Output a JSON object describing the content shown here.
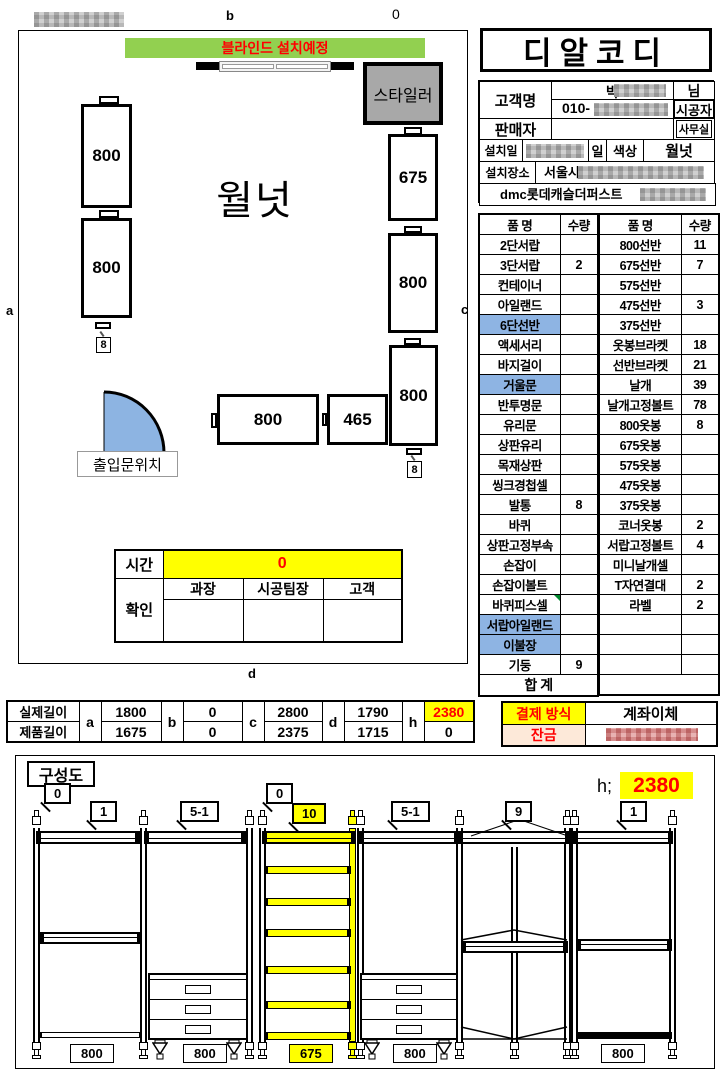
{
  "colors": {
    "banner_green": "#92D050",
    "highlight_blue": "#8EB4E3",
    "accent_yellow": "#FFFF00",
    "accent_red": "#FF0000",
    "styler_gray": "#A8A8A8",
    "door_blue": "#8DB4E2",
    "balance_bg": "#FDE9D9"
  },
  "plan": {
    "edge_labels": {
      "top": "b",
      "top_value": "0",
      "left": "a",
      "right": "c",
      "bottom": "d"
    },
    "banner": "블라인드 설치예정",
    "styler": "스타일러",
    "finish": "월넛",
    "door_label": "출입문위치",
    "units": {
      "left_1": "800",
      "left_2": "800",
      "mid_1": "800",
      "mid_2": "465",
      "right_1": "675",
      "right_2": "800",
      "right_3": "800"
    },
    "pole_markers": {
      "left": "8",
      "right": "8"
    },
    "time": {
      "label": "시간",
      "value": "0",
      "confirm_label": "확인",
      "signers": [
        "과장",
        "시공팀장",
        "고객"
      ]
    }
  },
  "header": {
    "company": "디알코디",
    "customer_label": "고객명",
    "customer_name": "박",
    "customer_suffix": "님",
    "phone_prefix": "010-",
    "installer": "시공자",
    "seller_label": "판매자",
    "office": "사무실",
    "date_label": "설치일",
    "date_suffix": "일",
    "color_label": "색상",
    "color_value": "월넛",
    "site_label": "설치장소",
    "site_city": "서울시",
    "site_detail": "dmc롯데캐슬더퍼스트"
  },
  "parts": {
    "headers": [
      "품 명",
      "수량"
    ],
    "left_rows": [
      {
        "name": "2단서랍",
        "qty": ""
      },
      {
        "name": "3단서랍",
        "qty": "2"
      },
      {
        "name": "컨테이너",
        "qty": ""
      },
      {
        "name": "아일랜드",
        "qty": ""
      },
      {
        "name": "6단선반",
        "qty": "",
        "hl": true
      },
      {
        "name": "액세서리",
        "qty": ""
      },
      {
        "name": "바지걸이",
        "qty": ""
      },
      {
        "name": "거울문",
        "qty": "",
        "hl": true
      },
      {
        "name": "반투명문",
        "qty": ""
      },
      {
        "name": "유리문",
        "qty": ""
      },
      {
        "name": "상판유리",
        "qty": ""
      },
      {
        "name": "목재상판",
        "qty": ""
      },
      {
        "name": "씽크경첩셀",
        "qty": ""
      },
      {
        "name": "발통",
        "qty": "8"
      },
      {
        "name": "바퀴",
        "qty": ""
      },
      {
        "name": "상판고정부속",
        "qty": ""
      },
      {
        "name": "손잡이",
        "qty": ""
      },
      {
        "name": "손잡이볼트",
        "qty": ""
      },
      {
        "name": "바퀴피스셀",
        "qty": "",
        "marker": true
      },
      {
        "name": "서랍아일랜드",
        "qty": "",
        "hl": true
      },
      {
        "name": "이불장",
        "qty": "",
        "hl": true
      },
      {
        "name": "기둥",
        "qty": "9"
      }
    ],
    "left_total": "합 계",
    "right_rows": [
      {
        "name": "800선반",
        "qty": "11"
      },
      {
        "name": "675선반",
        "qty": "7"
      },
      {
        "name": "575선반",
        "qty": ""
      },
      {
        "name": "475선반",
        "qty": "3"
      },
      {
        "name": "375선반",
        "qty": ""
      },
      {
        "name": "옷봉브라켓",
        "qty": "18"
      },
      {
        "name": "선반브라켓",
        "qty": "21"
      },
      {
        "name": "날개",
        "qty": "39"
      },
      {
        "name": "날개고정볼트",
        "qty": "78"
      },
      {
        "name": "800옷봉",
        "qty": "8"
      },
      {
        "name": "675옷봉",
        "qty": ""
      },
      {
        "name": "575옷봉",
        "qty": ""
      },
      {
        "name": "475옷봉",
        "qty": ""
      },
      {
        "name": "375옷봉",
        "qty": ""
      },
      {
        "name": "코너옷봉",
        "qty": "2"
      },
      {
        "name": "서랍고정볼트",
        "qty": "4"
      },
      {
        "name": "미니날개셀",
        "qty": ""
      },
      {
        "name": "T자연결대",
        "qty": "2"
      },
      {
        "name": "라벨",
        "qty": "2"
      },
      {
        "name": "",
        "qty": ""
      },
      {
        "name": "",
        "qty": ""
      },
      {
        "name": "",
        "qty": ""
      }
    ]
  },
  "lengths": {
    "row_labels": [
      "실제길이",
      "제품길이"
    ],
    "cols": [
      {
        "key": "a",
        "actual": "1800",
        "product": "1675"
      },
      {
        "key": "b",
        "actual": "0",
        "product": "0"
      },
      {
        "key": "c",
        "actual": "2800",
        "product": "2375"
      },
      {
        "key": "d",
        "actual": "1790",
        "product": "1715"
      },
      {
        "key": "h",
        "actual": "2380",
        "product": "0",
        "hl": true
      }
    ]
  },
  "payment": {
    "method_label": "결제 방식",
    "method_value": "계좌이체",
    "balance_label": "잔금"
  },
  "composition": {
    "title": "구성도",
    "height_prefix": "h;",
    "height_value": "2380",
    "callouts": [
      {
        "text": "0"
      },
      {
        "text": "1"
      },
      {
        "text": "5-1"
      },
      {
        "text": "0"
      },
      {
        "text": "10",
        "yellow": true
      },
      {
        "text": "5-1"
      },
      {
        "text": "9"
      },
      {
        "text": "1"
      }
    ],
    "width_labels": [
      {
        "text": "800"
      },
      {
        "text": "800"
      },
      {
        "text": "675",
        "yellow": true
      },
      {
        "text": "800"
      },
      {
        "text": "800"
      }
    ]
  }
}
